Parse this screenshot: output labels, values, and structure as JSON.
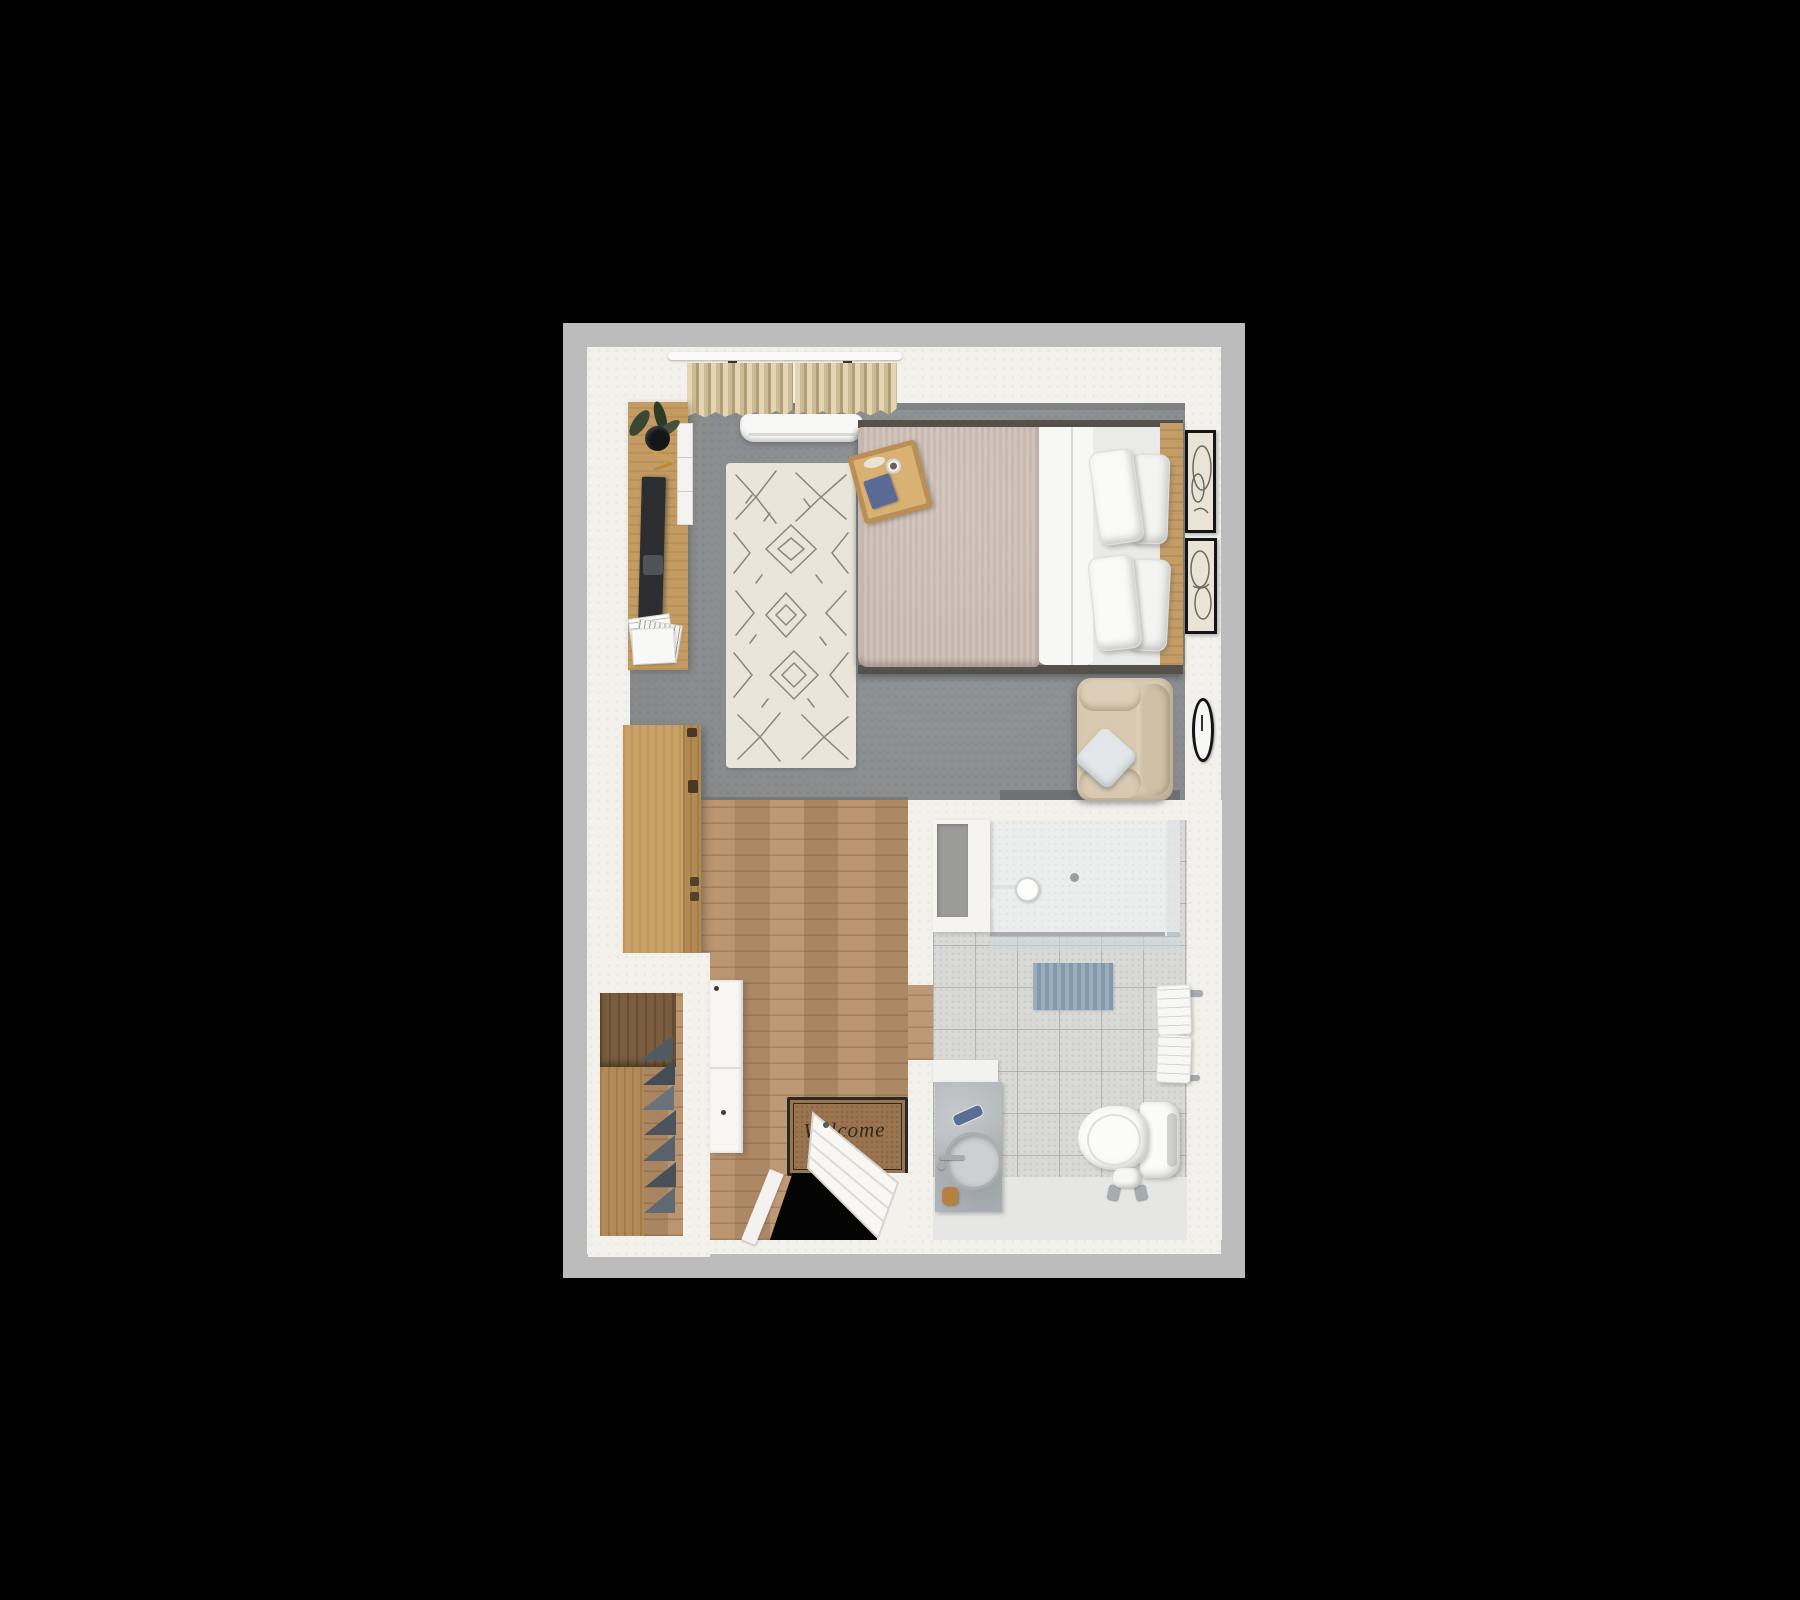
{
  "meta": {
    "description": "3D top-down rendered floor plan of a studio suite with bedroom, entry corridor, walk-in closet and bathroom on a black background",
    "view": "top-down 3D render",
    "background": "#000000"
  },
  "entry": {
    "mat_text": "Welcome",
    "door_state": "open"
  },
  "palette": {
    "outer_frame": "#bcbcbc",
    "wall_white": "#f3f1ec",
    "carpet_gray": "#8e9193",
    "wood_floor": "#b8906a",
    "rug_cream": "#e9e5da",
    "rug_pattern": "#6f6759",
    "duvet_taupe": "#cdbeb5",
    "sheet_white": "#f7f7f5",
    "headboard_wood": "#c49d66",
    "curtain_beige": "#d6c49e",
    "bath_tile": "#d9dad8",
    "shower_floor": "#eceded",
    "bath_mat_blue": "#8ea4b6",
    "armchair_beige": "#d8c9b0",
    "welcome_mat_brown": "#9a734f",
    "tv_dark": "#2b2d30",
    "book_blue": "#5a6a95",
    "frame_black": "#151515"
  },
  "inventory": {
    "bedroom": [
      "window curtains",
      "wall air-conditioner",
      "tv console with plant and magazines",
      "tv",
      "area rug",
      "double bed",
      "breakfast tray with book and cup",
      "two wall frames",
      "wall clock",
      "armchair with throw pillow",
      "dresser"
    ],
    "bathroom": [
      "vanity with mirror panel",
      "walk-in shower with glass screen",
      "shower head",
      "floor drain",
      "blue bath mat",
      "towel rail with towels",
      "toilet",
      "toilet paper stand",
      "stone wash basin column"
    ],
    "entry": [
      "walk-in closet with hanging clothes",
      "white storage cabinet",
      "welcome mat",
      "entry door"
    ]
  }
}
